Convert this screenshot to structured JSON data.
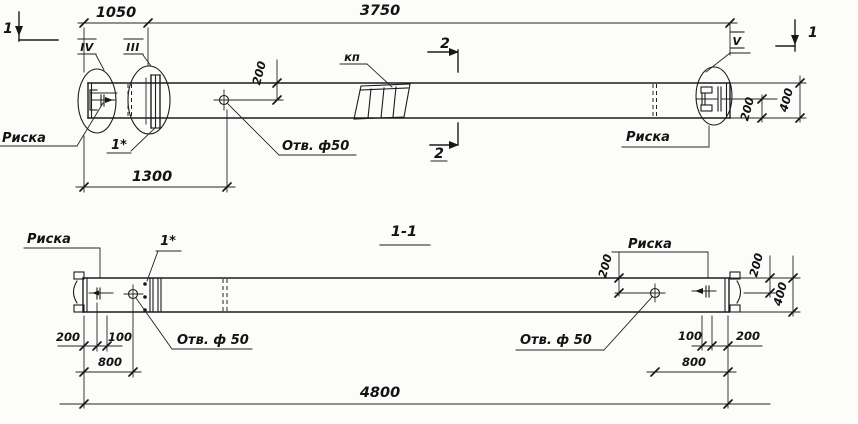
{
  "drawing": {
    "views": {
      "section_title": "1-1"
    },
    "labels": {
      "riska": "Риска",
      "hole_note": "Отв. ф 50",
      "hole_note_compact": "Отв. ф50",
      "kp": "кп",
      "pos1": "1*"
    },
    "callouts": {
      "roman3": "III",
      "roman4": "IV",
      "roman5": "V",
      "section1": "1",
      "section2": "2"
    },
    "dims": {
      "d1050": "1050",
      "d3750": "3750",
      "d1300": "1300",
      "d4800": "4800",
      "d800": "800",
      "d400": "400",
      "d200": "200",
      "d100": "100"
    }
  }
}
